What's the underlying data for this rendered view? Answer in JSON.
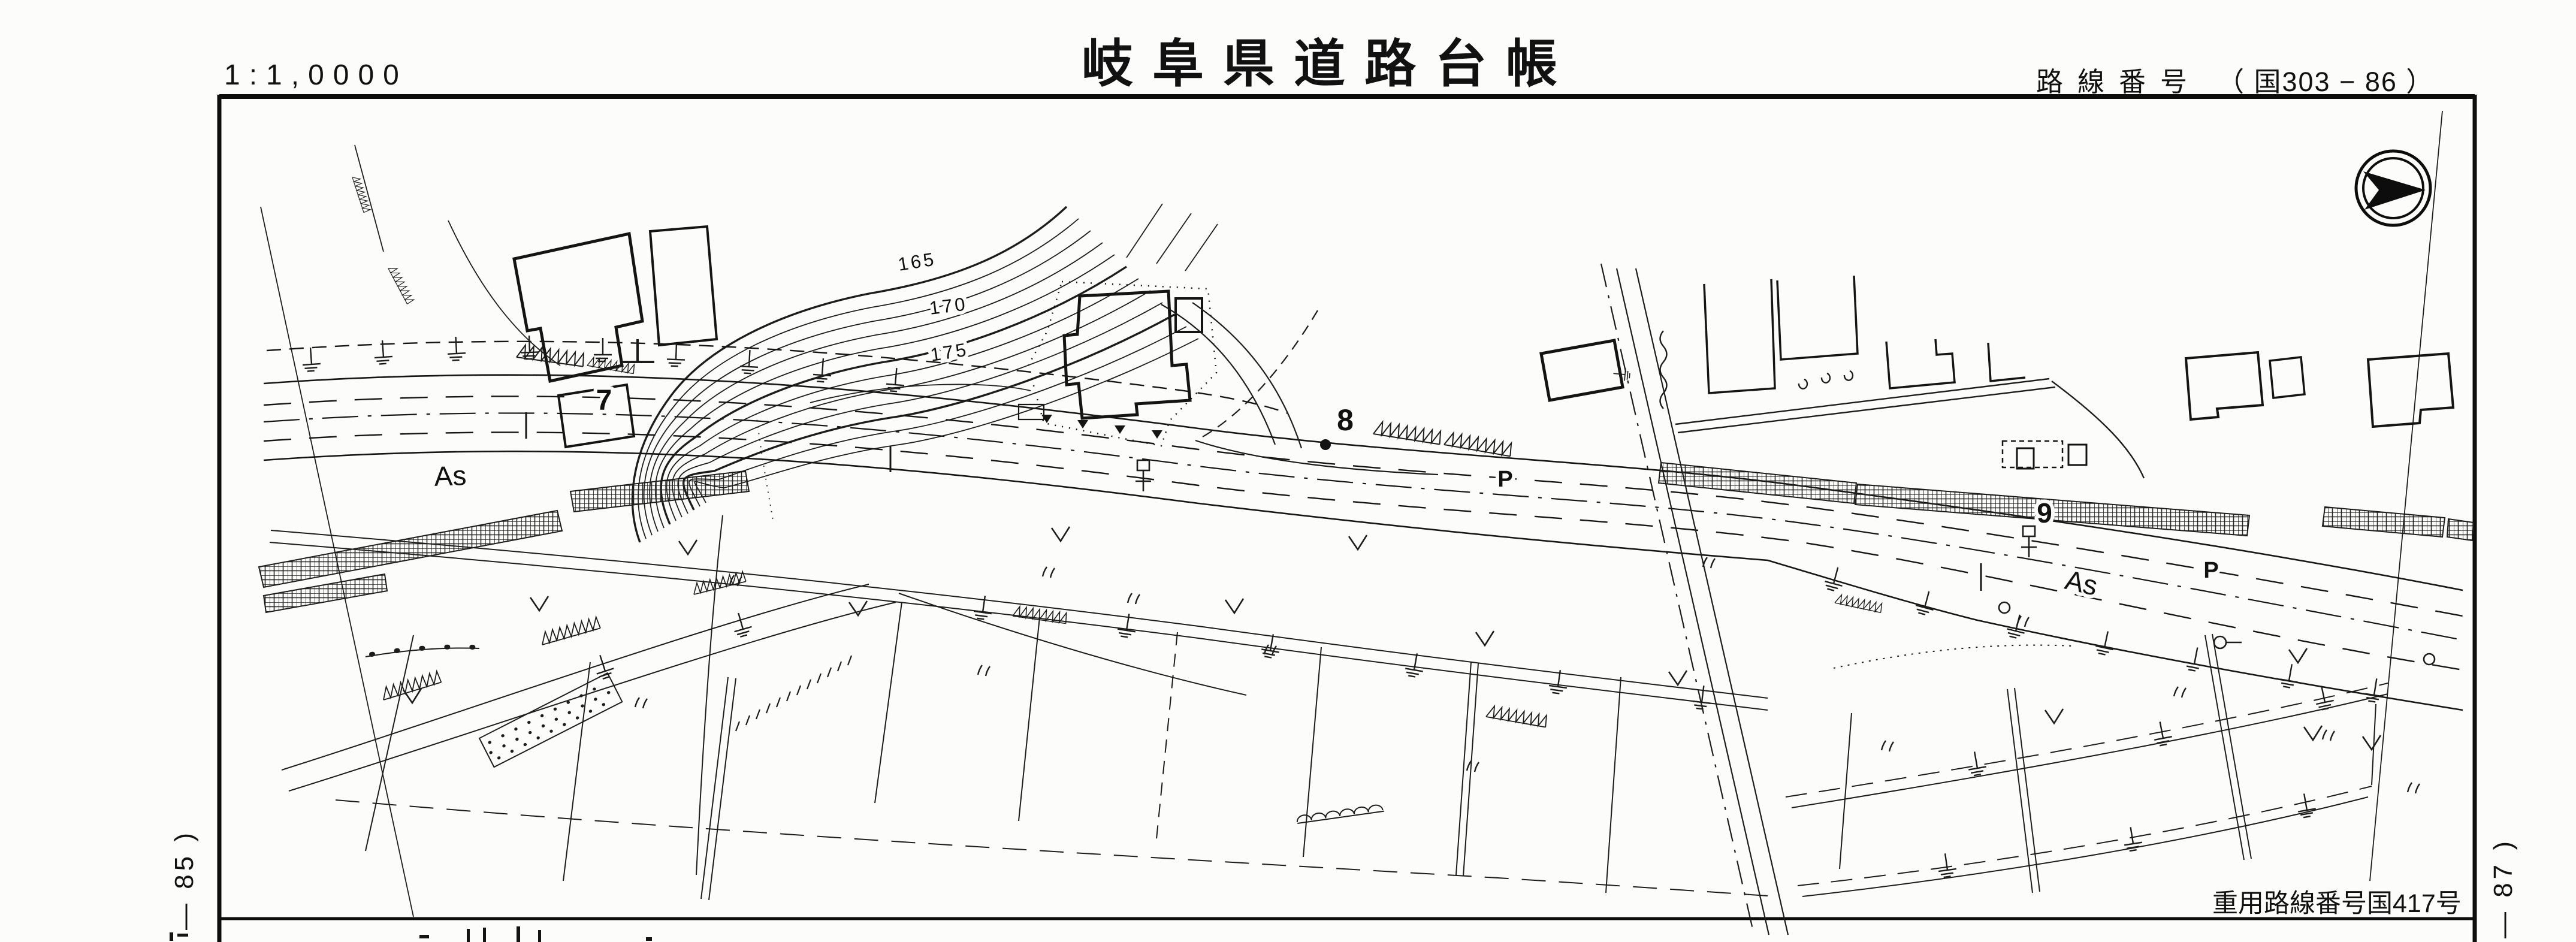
{
  "header": {
    "scale": "1:1,0000",
    "title": "岐阜県道路台帳",
    "route_label": "路線番号",
    "route_value": "（ 国303 − 86 ）"
  },
  "map": {
    "north_arrow": "north-arrow",
    "contour_labels": {
      "c165": "165",
      "c170": "170",
      "c175": "175"
    },
    "station_labels": {
      "s7": "7",
      "s8": "8",
      "s9": "9"
    },
    "surface_labels": {
      "as1": "As",
      "as2": "As"
    },
    "point_labels": {
      "p1": "P",
      "p2": "P"
    }
  },
  "footer": {
    "overlap_note": "重用路線番号国417号",
    "sheet_left": "— 85 )",
    "sheet_right": "— 87 )"
  }
}
